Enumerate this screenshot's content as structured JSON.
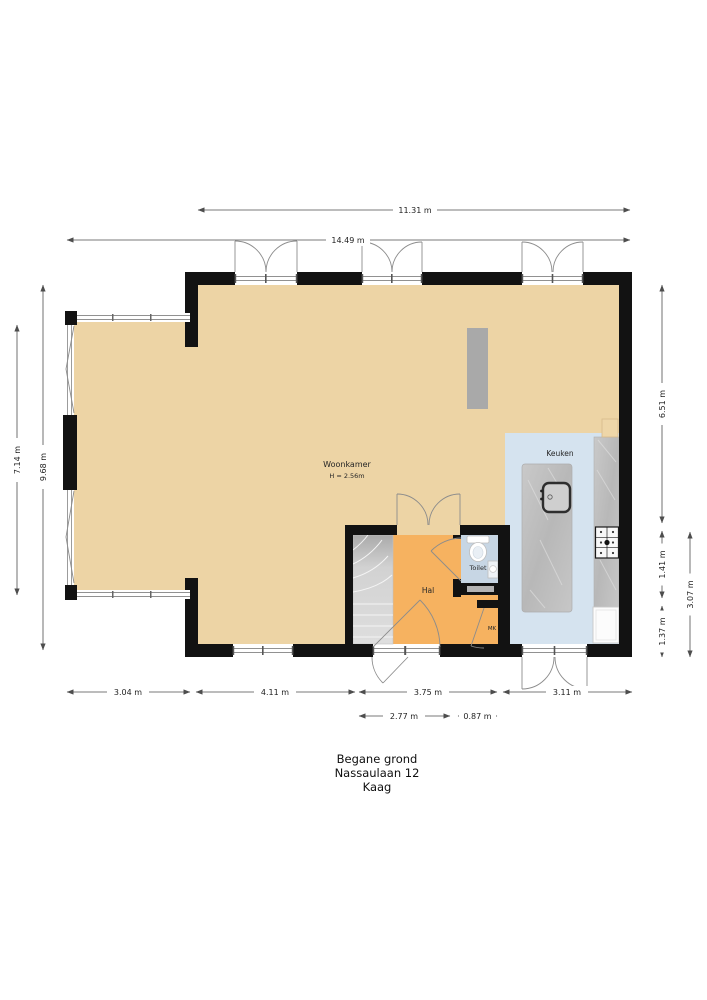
{
  "page": {
    "background": "#ffffff"
  },
  "plan": {
    "title": {
      "floor": "Begane grond",
      "address": "Nassaulaan 12",
      "city": "Kaag"
    },
    "rooms": {
      "woonkamer": {
        "label": "Woonkamer",
        "height_note": "H = 2.56m"
      },
      "keuken": {
        "label": "Keuken"
      },
      "hal": {
        "label": "Hal"
      },
      "toilet": {
        "label": "Toilet"
      },
      "mk": {
        "label": "MK"
      }
    },
    "dims": {
      "top_inner": "11.31 m",
      "top_outer": "14.49 m",
      "left_outer": "7.14 m",
      "left_inner": "9.68 m",
      "right_upper": "6.51 m",
      "right_mid": "1.41 m",
      "right_lower": "1.37 m",
      "right_outer": "3.07 m",
      "bottom_bay": "3.04 m",
      "bottom_living": "4.11 m",
      "bottom_hal": "3.75 m",
      "bottom_kitchen": "3.11 m",
      "bottom_sub_door": "2.77 m",
      "bottom_sub_mk": "0.87 m"
    },
    "colors": {
      "wall": "#121212",
      "floor_living": "#EDD4A5",
      "floor_hal": "#F6B260",
      "floor_kitchen": "#D5E3EF",
      "floor_toilet": "#C7D6E4",
      "stairs": "#D8D8D8",
      "counter_stone": "#C2C2C2",
      "column": "#A9A9A9",
      "dim_line": "#4D4D4D"
    }
  }
}
